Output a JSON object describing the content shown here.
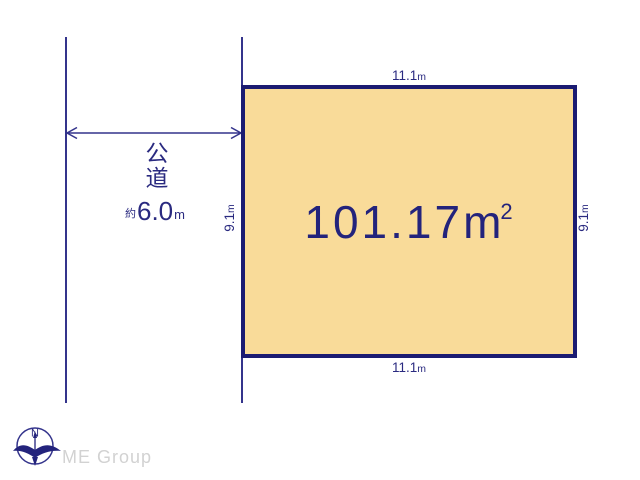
{
  "diagram": {
    "plot": {
      "area": {
        "value": "101.17",
        "unit": "m",
        "exponent": "2"
      },
      "dimensions": {
        "top": {
          "value": "11.1",
          "unit": "m"
        },
        "bottom": {
          "value": "11.1",
          "unit": "m"
        },
        "left": {
          "value": "9.1",
          "unit": "m"
        },
        "right": {
          "value": "9.1",
          "unit": "m"
        }
      },
      "fill_color": "#f9db99",
      "border_color": "#1b1b72"
    },
    "road": {
      "label": "公道",
      "width": {
        "prefix": "約",
        "value": "6.0",
        "unit": "m"
      }
    },
    "line_color": "#34348c"
  },
  "compass": {
    "label": "N"
  },
  "footer": {
    "brand": "ME Group"
  }
}
